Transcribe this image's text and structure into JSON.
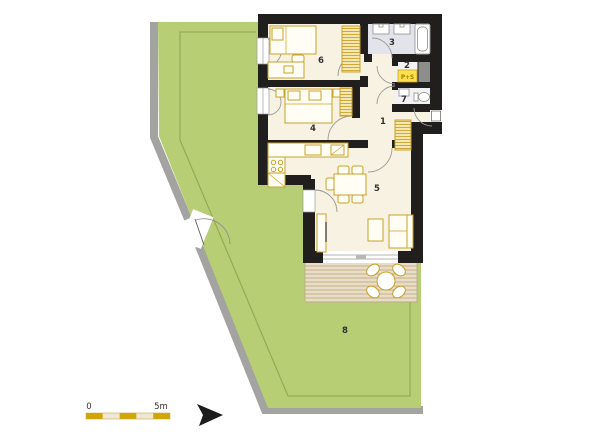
{
  "room_numbers": [
    "1",
    "2",
    "3",
    "4",
    "5",
    "6",
    "7",
    "8"
  ],
  "badge_ps": "P+S",
  "scale_bar": {
    "start": "0",
    "end": "5m"
  },
  "colors": {
    "garden_green": "#b8ce74",
    "garden_outline": "#94aa56",
    "fence_gray": "#a3a3a1",
    "wall_black": "#211f1d",
    "floor_cream": "#f8f2e2",
    "bath_floor": "#e3e3eb",
    "utility_floor": "#f2f2f4",
    "shaft_gray": "#8d8d8b",
    "furniture_gold": "#c9a227",
    "terrace_tan": "#e8ddc7",
    "terrace_stripe": "#ccb693",
    "scale_gold": "#d2a600",
    "scale_cream": "#efe7d3",
    "badge_yellow": "#ffe14d"
  }
}
